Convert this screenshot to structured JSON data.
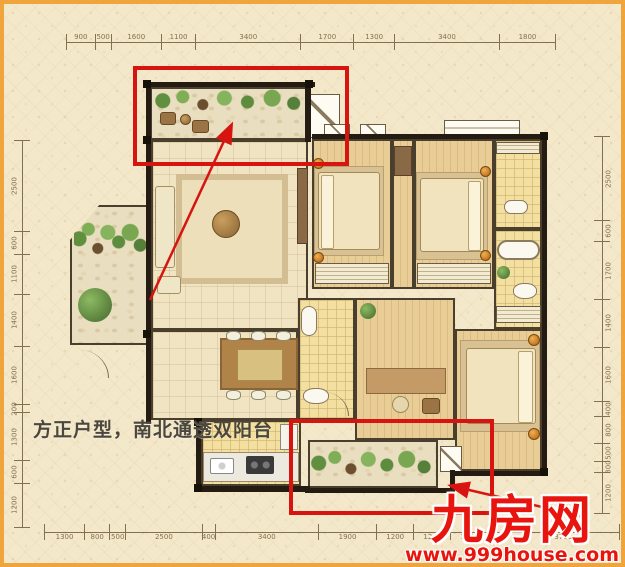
{
  "colors": {
    "frame": "#f0a43c",
    "background": "#f4e8cb",
    "highlight": "#d81410",
    "watermark": "#e8150f"
  },
  "slogan": {
    "text": "方正户型，南北通透双阳台"
  },
  "watermark": {
    "brand": "九房网",
    "url": "www.999house.com"
  },
  "dimensions": {
    "top": [
      "900",
      "500",
      "1600",
      "1100",
      "3400",
      "1700",
      "1300",
      "3400",
      "1800"
    ],
    "bottom": [
      "1300",
      "800",
      "500",
      "2500",
      "400",
      "3400",
      "1900",
      "1200",
      "1200",
      "1200",
      "600",
      "3700"
    ],
    "left": [
      "2500",
      "600",
      "1100",
      "1400",
      "1600",
      "200",
      "1300",
      "600",
      "1200"
    ],
    "right": [
      "2500",
      "600",
      "1700",
      "1400",
      "1600",
      "400",
      "800",
      "500",
      "300",
      "1200"
    ]
  }
}
